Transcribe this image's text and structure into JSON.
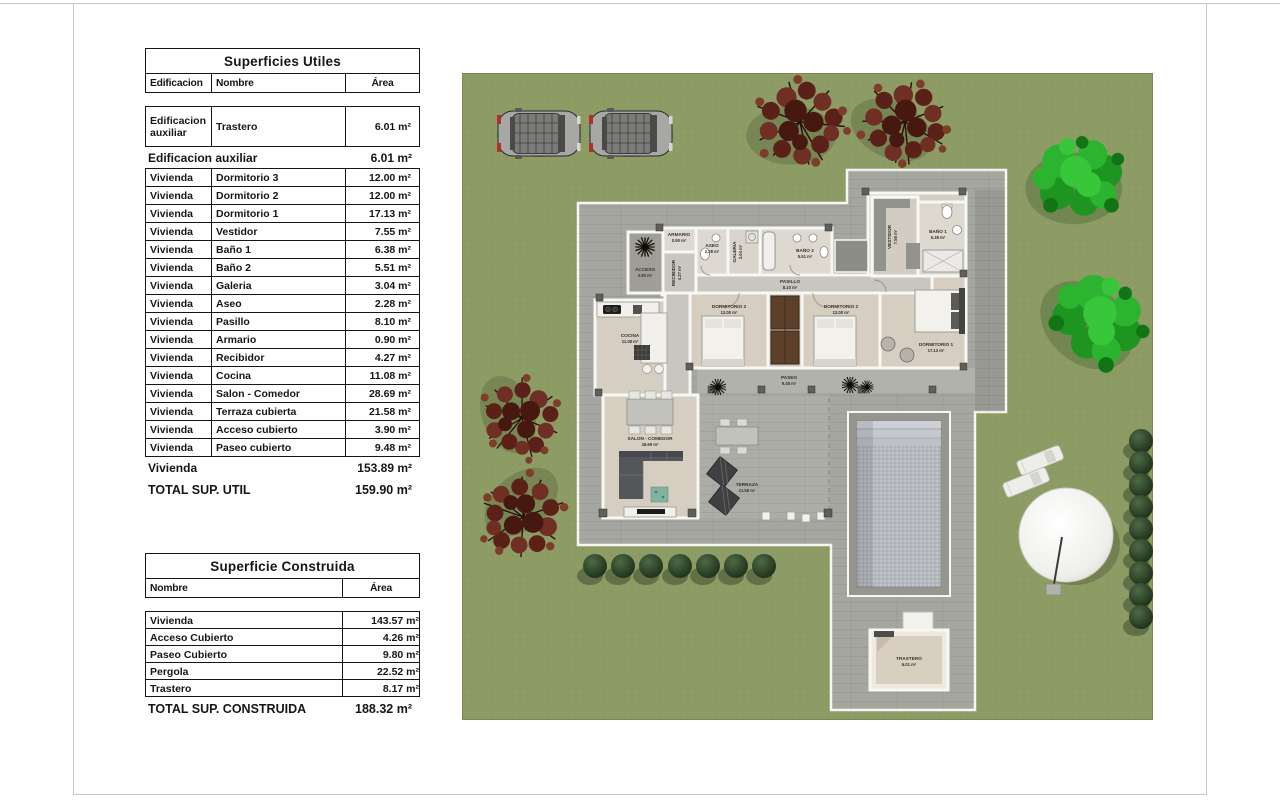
{
  "tables": {
    "useful": {
      "title": "Superficies Utiles",
      "headers": {
        "edificacion": "Edificacion",
        "nombre": "Nombre",
        "area": "Área"
      },
      "aux_rows": [
        {
          "e": "Edificacion auxiliar",
          "n": "Trastero",
          "a": "6.01 m²"
        }
      ],
      "aux_subtotal": {
        "label": "Edificacion auxiliar",
        "area": "6.01 m²"
      },
      "vivienda_rows": [
        {
          "e": "Vivienda",
          "n": "Dormitorio 3",
          "a": "12.00 m²"
        },
        {
          "e": "Vivienda",
          "n": "Dormitorio 2",
          "a": "12.00 m²"
        },
        {
          "e": "Vivienda",
          "n": "Dormitorio 1",
          "a": "17.13 m²"
        },
        {
          "e": "Vivienda",
          "n": "Vestidor",
          "a": "7.55 m²"
        },
        {
          "e": "Vivienda",
          "n": "Baño 1",
          "a": "6.38 m²"
        },
        {
          "e": "Vivienda",
          "n": "Baño 2",
          "a": "5.51 m²"
        },
        {
          "e": "Vivienda",
          "n": "Galeria",
          "a": "3.04 m²"
        },
        {
          "e": "Vivienda",
          "n": "Aseo",
          "a": "2.28 m²"
        },
        {
          "e": "Vivienda",
          "n": "Pasillo",
          "a": "8.10 m²"
        },
        {
          "e": "Vivienda",
          "n": "Armario",
          "a": "0.90 m²"
        },
        {
          "e": "Vivienda",
          "n": "Recibidor",
          "a": "4.27 m²"
        },
        {
          "e": "Vivienda",
          "n": "Cocina",
          "a": "11.08 m²"
        },
        {
          "e": "Vivienda",
          "n": "Salon - Comedor",
          "a": "28.69 m²"
        },
        {
          "e": "Vivienda",
          "n": "Terraza cubierta",
          "a": "21.58 m²"
        },
        {
          "e": "Vivienda",
          "n": "Acceso cubierto",
          "a": "3.90 m²"
        },
        {
          "e": "Vivienda",
          "n": "Paseo cubierto",
          "a": "9.48 m²"
        }
      ],
      "vivienda_subtotal": {
        "label": "Vivienda",
        "area": "153.89 m²"
      },
      "total": {
        "label": "TOTAL SUP. UTIL",
        "area": "159.90 m²"
      }
    },
    "built": {
      "title": "Superficie Construida",
      "headers": {
        "nombre": "Nombre",
        "area": "Área"
      },
      "rows": [
        {
          "n": "Vivienda",
          "a": "143.57 m²"
        },
        {
          "n": "Acceso Cubierto",
          "a": "4.26 m²"
        },
        {
          "n": "Paseo Cubierto",
          "a": "9.80 m²"
        },
        {
          "n": "Pergola",
          "a": "22.52 m²"
        },
        {
          "n": "Trastero",
          "a": "8.17 m²"
        }
      ],
      "total": {
        "label": "TOTAL SUP. CONSTRUIDA",
        "area": "188.32 m²"
      }
    }
  },
  "plan": {
    "rooms": [
      {
        "name": "ACCESO",
        "area": "3.90 m²"
      },
      {
        "name": "RECIBIDOR",
        "area": "4.27 m²"
      },
      {
        "name": "ARMARIO",
        "area": "0.90 m²"
      },
      {
        "name": "ASEO",
        "area": "2.28 m²"
      },
      {
        "name": "GALERIA",
        "area": "3.04 m²"
      },
      {
        "name": "BAÑO 2",
        "area": "5.51 m²"
      },
      {
        "name": "PASILLO",
        "area": "8.10 m²"
      },
      {
        "name": "DORMITORIO 3",
        "area": "12.00 m²"
      },
      {
        "name": "DORMITORIO 2",
        "area": "12.00 m²"
      },
      {
        "name": "DORMITORIO 1",
        "area": "17.13 m²"
      },
      {
        "name": "VESTIDOR",
        "area": "7.55 m²"
      },
      {
        "name": "BAÑO 1",
        "area": "6.38 m²"
      },
      {
        "name": "COCINA",
        "area": "11.08 m²"
      },
      {
        "name": "SALON - COMEDOR",
        "area": "28.69 m²"
      },
      {
        "name": "TERRAZA",
        "area": "21.58 m²"
      },
      {
        "name": "PASEO",
        "area": "9.48 m²"
      },
      {
        "name": "TRASTERO",
        "area": "6.01 m²"
      }
    ],
    "colors": {
      "lawn": "#8d9b65",
      "paving": "#a6a6a0",
      "pool_water": "#b6babf",
      "wood_floor": "#d6cfc1",
      "red_tree": "#5b2119",
      "green_tree": "#2cb32f",
      "bush": "#2c4429",
      "parasol": "#f3f3f0"
    }
  }
}
